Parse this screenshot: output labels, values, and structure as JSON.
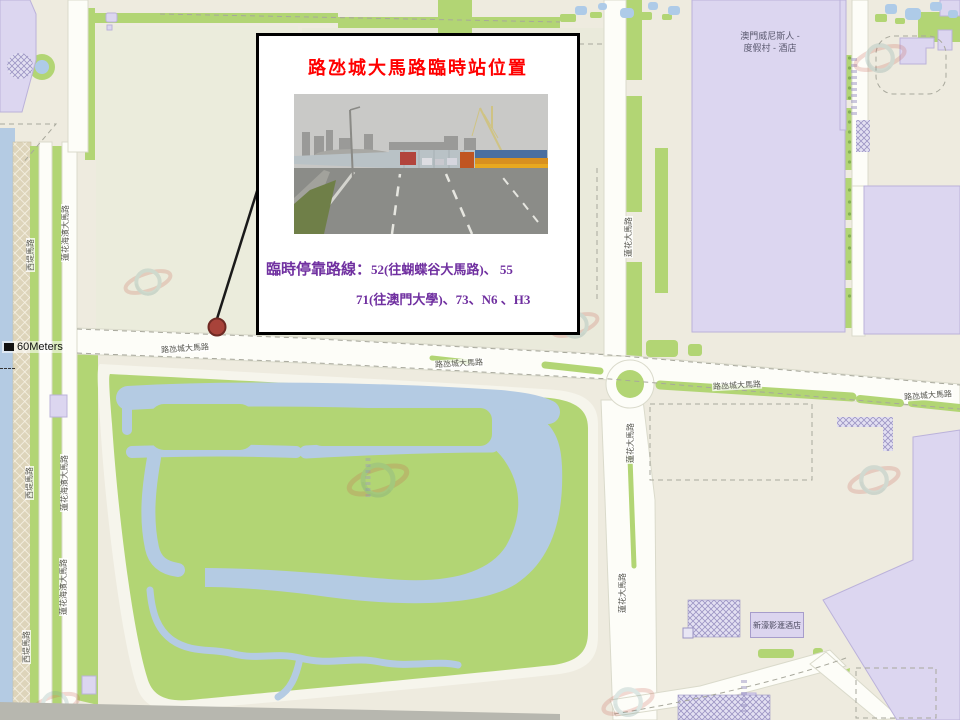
{
  "annotation": {
    "title": "路氹城大馬路臨時站位置",
    "routes_prefix": "臨時停靠路線：",
    "routes_line1": "52(往蝴蝶谷大馬路)、 55",
    "routes_line2": "71(往澳門大學)、73、N6 、H3"
  },
  "map": {
    "scale_label": "60Meters",
    "road_labels": {
      "cotai_1": "路氹城大馬路",
      "cotai_2": "路氹城大馬路",
      "cotai_3": "路氹城大馬路",
      "cotai_4": "路氹城大馬路",
      "saitai_1": "西堤馬路",
      "saitai_2": "西堤馬路",
      "saitai_3": "西堤馬路",
      "marginal_1": "蓮花海濱大馬路",
      "marginal_2": "蓮花海濱大馬路",
      "marginal_3": "蓮花海濱大馬路",
      "lotus_1": "蓮花大馬路",
      "lotus_2": "蓮花大馬路",
      "lotus_3": "蓮花大馬路"
    },
    "places": {
      "venetian_line1": "澳門威尼斯人 -",
      "venetian_line2": "度假村 - 酒店",
      "studio_city": "新濠影滙酒店"
    }
  },
  "colors": {
    "title_red": "#FF0000",
    "route_purple": "#7030A0",
    "marker_fill": "#A8433A",
    "water_blue": "#B4CBE3",
    "park_green": "#B2D574",
    "building_purple": "#DCD6F0"
  }
}
